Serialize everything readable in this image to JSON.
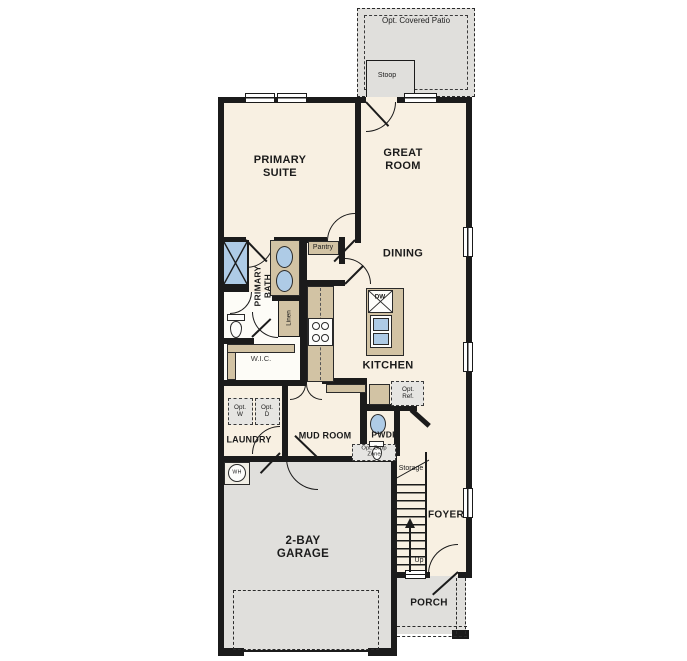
{
  "plan": {
    "patio": {
      "label": "Opt. Covered Patio"
    },
    "stoop": {
      "label": "Stoop"
    },
    "primary_suite": {
      "line1": "PRIMARY",
      "line2": "SUITE"
    },
    "great_room": {
      "line1": "GREAT",
      "line2": "ROOM"
    },
    "dining": {
      "label": "DINING"
    },
    "pantry": {
      "label": "Pantry"
    },
    "primary_bath": {
      "line1": "PRIMARY",
      "line2": "BATH"
    },
    "linen": {
      "label": "Linen"
    },
    "wic": {
      "label": "W.I.C."
    },
    "kitchen": {
      "label": "KITCHEN"
    },
    "island": {
      "dishwasher": "DW"
    },
    "laundry": {
      "label": "LAUNDRY",
      "opt_washer": {
        "line1": "Opt.",
        "line2": "W"
      },
      "opt_dryer": {
        "line1": "Opt.",
        "line2": "D"
      }
    },
    "mud_room": {
      "label": "MUD ROOM",
      "drop_zone": {
        "line1": "Opt. Drop",
        "line2": "Zone"
      }
    },
    "opt_ref": {
      "line1": "Opt.",
      "line2": "Ref."
    },
    "pwdr": {
      "label": "PWDR"
    },
    "storage": {
      "label": "Storage"
    },
    "stairs": {
      "up": "Up"
    },
    "foyer": {
      "label": "FOYER"
    },
    "garage": {
      "line1": "2-BAY",
      "line2": "GARAGE",
      "water_heater": "WH"
    },
    "porch": {
      "label": "PORCH"
    }
  },
  "colors": {
    "wall": "#1b1b1b",
    "room_fill": "#f8f0e2",
    "exterior_gray": "#e0dfdc",
    "cabinet_tan": "#d2c3a4",
    "fixture_blue": "#aecbe6",
    "optional_fill": "#e6e5e2"
  }
}
